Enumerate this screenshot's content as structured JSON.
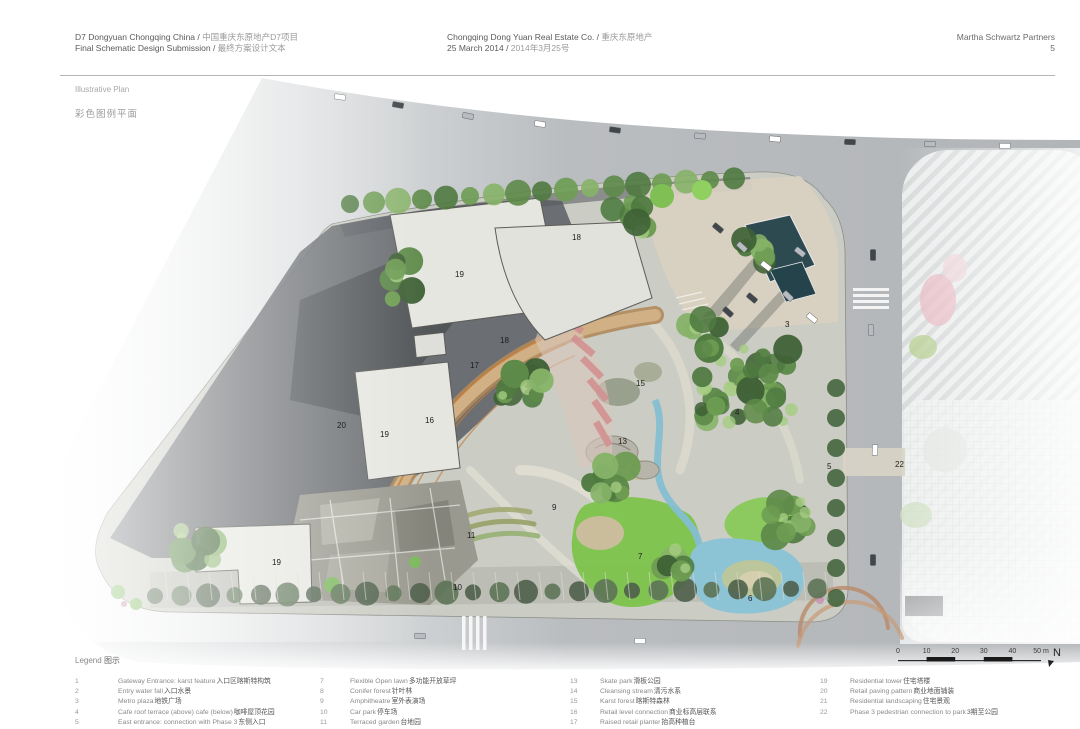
{
  "header": {
    "left": {
      "line1_en": "D7 Dongyuan Chongqing China / ",
      "line1_zh": "中国重庆东原地产D7项目",
      "line2_en": "Final Schematic Design Submission / ",
      "line2_zh": "最终方案设计文本"
    },
    "center": {
      "line1_en": "Chongqing Dong Yuan Real Estate Co. / ",
      "line1_zh": "重庆东原地产",
      "line2_en": "25 March 2014 / ",
      "line2_zh": "2014年3月25号"
    },
    "right": {
      "firm": "Martha Schwartz Partners",
      "page": "5"
    }
  },
  "plan_title": {
    "en": "Illustrative Plan",
    "zh": "彩色图例平面"
  },
  "legend": {
    "title_en": "Legend",
    "title_zh": "图示",
    "columns": [
      [
        {
          "num": "1",
          "en": "Gateway Entrance: karst feature ",
          "zh": "入口区喀斯特构筑"
        },
        {
          "num": "2",
          "en": "Entry water fall ",
          "zh": "入口水景"
        },
        {
          "num": "3",
          "en": "Metro plaza ",
          "zh": "地铁广场"
        },
        {
          "num": "4",
          "en": "Cafe roof terrace (above) cafe (below) ",
          "zh": "咖啡屋顶花园"
        },
        {
          "num": "5",
          "en": "East entrance: connection with Phase 3 ",
          "zh": "东侧入口"
        }
      ],
      [
        {
          "num": "7",
          "en": "Flexible Open lawn ",
          "zh": "多功能开放草坪"
        },
        {
          "num": "8",
          "en": "Conifer forest ",
          "zh": "针叶林"
        },
        {
          "num": "9",
          "en": "Amphitheatre ",
          "zh": "室外表演场"
        },
        {
          "num": "10",
          "en": "Car park ",
          "zh": "停车场"
        },
        {
          "num": "11",
          "en": "Terraced garden ",
          "zh": "台地园"
        }
      ],
      [
        {
          "num": "13",
          "en": "Skate park ",
          "zh": "滑板公园"
        },
        {
          "num": "14",
          "en": "Cleansing stream ",
          "zh": "清污水系"
        },
        {
          "num": "15",
          "en": "Karst forest ",
          "zh": "喀斯特森林"
        },
        {
          "num": "16",
          "en": "Retail level connection ",
          "zh": "商业标高层联系"
        },
        {
          "num": "17",
          "en": "Raised retail planter ",
          "zh": "抬高种植台"
        }
      ],
      [
        {
          "num": "19",
          "en": "Residential tower ",
          "zh": "住宅塔楼"
        },
        {
          "num": "20",
          "en": "Retail paving pattern ",
          "zh": "商业地面铺装"
        },
        {
          "num": "21",
          "en": "Residential landscaping ",
          "zh": "住宅景观"
        },
        {
          "num": "22",
          "en": "Phase 3 pedestrian connection to park ",
          "zh": "3期至公园"
        }
      ]
    ]
  },
  "plan_labels": [
    {
      "n": "19",
      "x": 455,
      "y": 277
    },
    {
      "n": "18",
      "x": 572,
      "y": 240
    },
    {
      "n": "3",
      "x": 785,
      "y": 327
    },
    {
      "n": "18",
      "x": 500,
      "y": 343
    },
    {
      "n": "17",
      "x": 470,
      "y": 368
    },
    {
      "n": "15",
      "x": 636,
      "y": 386
    },
    {
      "n": "4",
      "x": 735,
      "y": 415
    },
    {
      "n": "16",
      "x": 425,
      "y": 423
    },
    {
      "n": "20",
      "x": 337,
      "y": 428
    },
    {
      "n": "19",
      "x": 380,
      "y": 437
    },
    {
      "n": "13",
      "x": 618,
      "y": 444
    },
    {
      "n": "5",
      "x": 827,
      "y": 469
    },
    {
      "n": "22",
      "x": 895,
      "y": 467
    },
    {
      "n": "9",
      "x": 552,
      "y": 510
    },
    {
      "n": "11",
      "x": 467,
      "y": 538
    },
    {
      "n": "7",
      "x": 638,
      "y": 559
    },
    {
      "n": "19",
      "x": 272,
      "y": 565
    },
    {
      "n": "10",
      "x": 453,
      "y": 590
    },
    {
      "n": "6",
      "x": 748,
      "y": 601
    }
  ],
  "scale_bar": {
    "ticks": [
      "0",
      "10",
      "20",
      "30",
      "40",
      "50 m"
    ],
    "north": "N"
  },
  "palette": {
    "road": "#b7babd",
    "site_base": "#cbccc3",
    "dark_paving": "#5d6166",
    "building": "#e6e6e1",
    "lawn_green": "#7cc34b",
    "tree_green": "#6d9c52",
    "water_blue": "#8cc4d6",
    "terrace_pink": "#d29090",
    "path_tan": "#c9a87a",
    "plaza_beige": "#d8d1c2",
    "canopy_teal": "#2c4a50",
    "phase3_stripe": "#d8dadb"
  }
}
